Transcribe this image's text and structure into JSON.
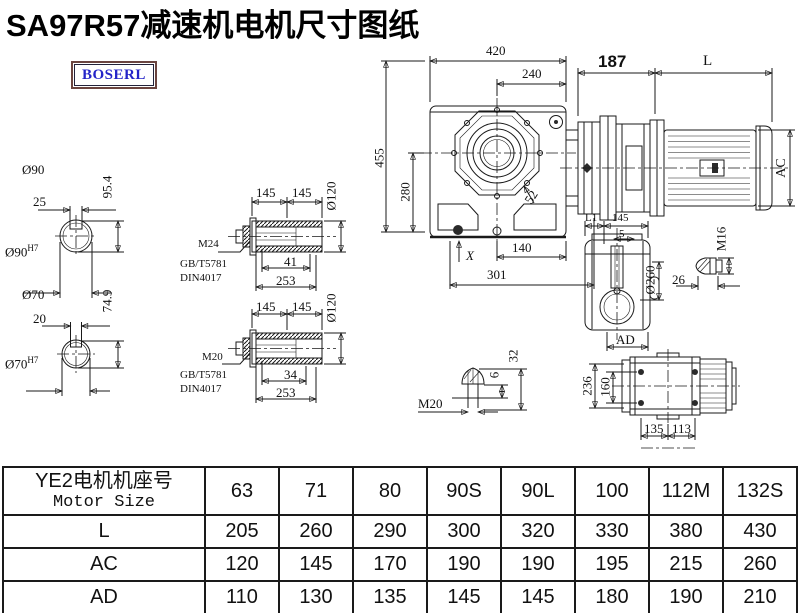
{
  "title": "SA97R57减速机电机尺寸图纸",
  "logo": {
    "text": "BOSERL"
  },
  "drawing": {
    "front_view": {
      "width": "420",
      "half_width": "240",
      "height": "455",
      "lower_height": "280",
      "bolt_offset": "52",
      "foot": "X",
      "half_base": "140",
      "base": "301"
    },
    "motor": {
      "flange_length": "187",
      "body_length": "L",
      "frame_diameter": "AC"
    },
    "solid_shaft_top": {
      "diameter": "Ø90",
      "key_length": "25",
      "overall": "95.4",
      "fit": "Ø90",
      "tolerance": "H7"
    },
    "solid_shaft_bottom": {
      "diameter": "Ø70",
      "key_length": "20",
      "overall": "74.9",
      "fit": "Ø70",
      "tolerance": "H7"
    },
    "hollow_shaft_top": {
      "seg1": "145",
      "seg2": "145",
      "bore": "Ø120",
      "bolt": "M24",
      "standard1": "GB/T5781",
      "standard2": "DIN4017",
      "depth": "41",
      "length": "253"
    },
    "hollow_shaft_bottom": {
      "seg1": "145",
      "seg2": "145",
      "bore": "Ø120",
      "bolt": "M20",
      "standard1": "GB/T5781",
      "standard2": "DIN4017",
      "depth": "34",
      "length": "253"
    },
    "side_view": {
      "l1": "L1",
      "length": "145",
      "gap": "5",
      "flange_diameter": "Ø260",
      "ad": "AD"
    },
    "side_plug": {
      "thread": "M16",
      "length": "26"
    },
    "bottom_plug": {
      "thread": "M20",
      "tip": "6",
      "length": "32"
    },
    "mount_view": {
      "height": "236",
      "bolt_spacing": "160",
      "left": "135",
      "right": "113"
    }
  },
  "table": {
    "header_cn": "YE2电机机座号",
    "header_en": "Motor Size",
    "sizes": [
      "63",
      "71",
      "80",
      "90S",
      "90L",
      "100",
      "112M",
      "132S"
    ],
    "rows": [
      {
        "label": "L",
        "values": [
          "205",
          "260",
          "290",
          "300",
          "320",
          "330",
          "380",
          "430"
        ]
      },
      {
        "label": "AC",
        "values": [
          "120",
          "145",
          "170",
          "190",
          "190",
          "195",
          "215",
          "260"
        ]
      },
      {
        "label": "AD",
        "values": [
          "110",
          "130",
          "135",
          "145",
          "145",
          "180",
          "190",
          "210"
        ]
      }
    ]
  },
  "colors": {
    "line": "#1a1a1a",
    "logo_text": "#2323c8",
    "logo_border": "#6b4540"
  }
}
